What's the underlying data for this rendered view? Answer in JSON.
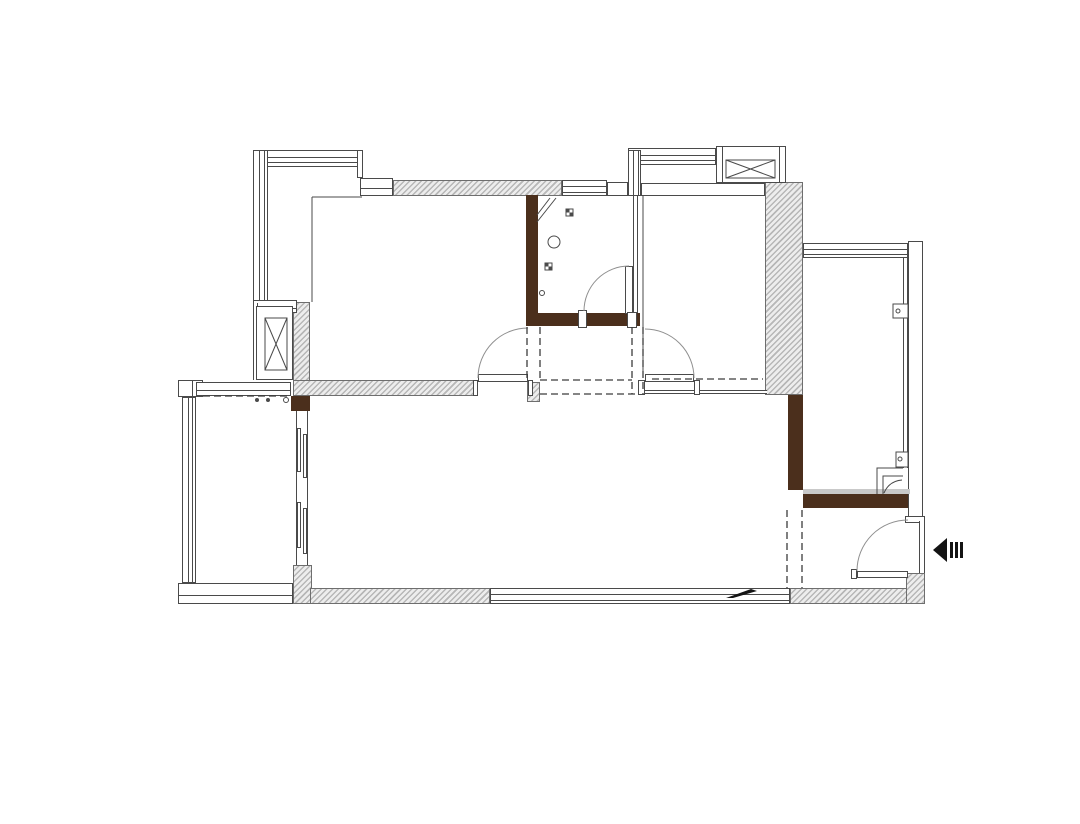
{
  "canvas": {
    "width": 1080,
    "height": 824,
    "background": "#ffffff"
  },
  "colors": {
    "line": "#4a4a4a",
    "arc": "#8f8f8f",
    "dash": "#3c3c3c",
    "black": "#141414",
    "wall_brown": "#4b2f1c",
    "hatch_bg": "#ededed",
    "hatch_stripe": "#b7b7b7",
    "gray_band": "#c9c9c9",
    "paper": "#ffffff"
  },
  "plan": {
    "hatched_walls": [
      {
        "name": "wall-top-bedroom1",
        "x": 393,
        "y": 180,
        "w": 169,
        "h": 16
      },
      {
        "name": "wall-left-shaft-side",
        "x": 293,
        "y": 302,
        "w": 17,
        "h": 82
      },
      {
        "name": "wall-bedroom1-south",
        "x": 293,
        "y": 380,
        "w": 185,
        "h": 16
      },
      {
        "name": "wall-hall-corner",
        "x": 527,
        "y": 382,
        "w": 13,
        "h": 20
      },
      {
        "name": "wall-bedroom2-east",
        "x": 765,
        "y": 182,
        "w": 38,
        "h": 213
      },
      {
        "name": "wall-balcony-pier",
        "x": 293,
        "y": 565,
        "w": 19,
        "h": 39
      },
      {
        "name": "wall-living-south",
        "x": 310,
        "y": 588,
        "w": 180,
        "h": 16
      },
      {
        "name": "wall-entry-south",
        "x": 790,
        "y": 588,
        "w": 118,
        "h": 16
      },
      {
        "name": "wall-entry-corner",
        "x": 906,
        "y": 573,
        "w": 19,
        "h": 31
      }
    ],
    "brown_walls": [
      {
        "name": "wall-bathroom-west",
        "x": 526,
        "y": 195,
        "w": 12,
        "h": 130
      },
      {
        "name": "wall-bathroom-south",
        "x": 526,
        "y": 313,
        "w": 114,
        "h": 13
      },
      {
        "name": "wall-balcony-door-pier",
        "x": 291,
        "y": 396,
        "w": 19,
        "h": 15
      },
      {
        "name": "wall-living-east",
        "x": 788,
        "y": 395,
        "w": 15,
        "h": 95
      },
      {
        "name": "wall-entry-north",
        "x": 803,
        "y": 494,
        "w": 107,
        "h": 14
      }
    ],
    "white_bands": [
      {
        "name": "bay-window-north",
        "x": 253,
        "y": 150,
        "w": 107,
        "h": 17,
        "style": "h2"
      },
      {
        "name": "bay-window-west",
        "x": 253,
        "y": 150,
        "w": 15,
        "h": 153,
        "style": "v2"
      },
      {
        "name": "bay-window-cap",
        "x": 357,
        "y": 150,
        "w": 6,
        "h": 28,
        "style": "box"
      },
      {
        "name": "bay-step-band",
        "x": 360,
        "y": 178,
        "w": 33,
        "h": 18,
        "style": "h1"
      },
      {
        "name": "bay-sill-band",
        "x": 253,
        "y": 300,
        "w": 44,
        "h": 13,
        "style": "h1"
      },
      {
        "name": "bay-edge-line",
        "x": 253,
        "y": 303,
        "w": 5,
        "h": 77,
        "style": "v2only"
      },
      {
        "name": "shaft-left-box",
        "x": 256,
        "y": 306,
        "w": 37,
        "h": 74,
        "style": "box"
      },
      {
        "name": "bathroom-window",
        "x": 562,
        "y": 180,
        "w": 45,
        "h": 16,
        "style": "h2"
      },
      {
        "name": "wall-band-bath-ne",
        "x": 607,
        "y": 182,
        "w": 21,
        "h": 14,
        "style": "box"
      },
      {
        "name": "tr-bay-window-north",
        "x": 628,
        "y": 148,
        "w": 88,
        "h": 17,
        "style": "h2"
      },
      {
        "name": "tr-bay-window-west",
        "x": 628,
        "y": 150,
        "w": 13,
        "h": 46,
        "style": "v2"
      },
      {
        "name": "shaft-right-box",
        "x": 716,
        "y": 146,
        "w": 70,
        "h": 37,
        "style": "box"
      },
      {
        "name": "shaft-right-cap-left",
        "x": 716,
        "y": 146,
        "w": 7,
        "h": 37,
        "style": "box"
      },
      {
        "name": "shaft-right-cap-right",
        "x": 779,
        "y": 146,
        "w": 7,
        "h": 37,
        "style": "box"
      },
      {
        "name": "bedroom2-north-band",
        "x": 641,
        "y": 183,
        "w": 124,
        "h": 13,
        "style": "box"
      },
      {
        "name": "balcony-window-end-block",
        "x": 178,
        "y": 380,
        "w": 25,
        "h": 17,
        "style": "v1"
      },
      {
        "name": "balcony-north-band",
        "x": 196,
        "y": 382,
        "w": 95,
        "h": 14,
        "style": "h1"
      },
      {
        "name": "balcony-window-west",
        "x": 182,
        "y": 397,
        "w": 14,
        "h": 186,
        "style": "v2"
      },
      {
        "name": "balcony-south-band",
        "x": 178,
        "y": 583,
        "w": 115,
        "h": 21,
        "style": "h1"
      },
      {
        "name": "living-south-window",
        "x": 490,
        "y": 588,
        "w": 300,
        "h": 16,
        "style": "h2"
      },
      {
        "name": "rbalcony-north-window",
        "x": 803,
        "y": 243,
        "w": 105,
        "h": 15,
        "style": "h2"
      },
      {
        "name": "rbalcony-east-column",
        "x": 908,
        "y": 241,
        "w": 15,
        "h": 277,
        "style": "box"
      },
      {
        "name": "column-foot-cap",
        "x": 905,
        "y": 516,
        "w": 20,
        "h": 7,
        "style": "box"
      },
      {
        "name": "rbalcony-east-window-line",
        "x": 903,
        "y": 258,
        "w": 5,
        "h": 210,
        "style": "v2only"
      },
      {
        "name": "entry-east-edge",
        "x": 919,
        "y": 521,
        "w": 6,
        "h": 52,
        "style": "v2only"
      },
      {
        "name": "sliding-door-frame",
        "x": 296,
        "y": 411,
        "w": 12,
        "h": 154,
        "style": "v2only"
      },
      {
        "name": "sliding-panel-1",
        "x": 297,
        "y": 428,
        "w": 4,
        "h": 44,
        "style": "box"
      },
      {
        "name": "sliding-panel-2",
        "x": 303,
        "y": 434,
        "w": 4,
        "h": 44,
        "style": "box"
      },
      {
        "name": "sliding-panel-3",
        "x": 297,
        "y": 502,
        "w": 4,
        "h": 46,
        "style": "box"
      },
      {
        "name": "sliding-panel-4",
        "x": 303,
        "y": 508,
        "w": 4,
        "h": 46,
        "style": "box"
      },
      {
        "name": "bathroom-east-wall",
        "x": 633,
        "y": 196,
        "w": 5,
        "h": 117,
        "style": "v2only"
      },
      {
        "name": "bedroom2-south-sill",
        "x": 645,
        "y": 390,
        "w": 122,
        "h": 4,
        "style": "h2only"
      },
      {
        "name": "door-leaf-bedroom1",
        "x": 478,
        "y": 374,
        "w": 50,
        "h": 8,
        "style": "box"
      },
      {
        "name": "door-jamb-bedroom1-left",
        "x": 473,
        "y": 380,
        "w": 5,
        "h": 16,
        "style": "box"
      },
      {
        "name": "door-jamb-bedroom1-right",
        "x": 528,
        "y": 380,
        "w": 5,
        "h": 16,
        "style": "box"
      },
      {
        "name": "door-leaf-bedroom2",
        "x": 645,
        "y": 374,
        "w": 49,
        "h": 8,
        "style": "box"
      },
      {
        "name": "door-jamb-bedroom2-left",
        "x": 638,
        "y": 380,
        "w": 7,
        "h": 15,
        "style": "box"
      },
      {
        "name": "door-jamb-bedroom2-right",
        "x": 694,
        "y": 380,
        "w": 6,
        "h": 15,
        "style": "box"
      },
      {
        "name": "door-leaf-bathroom",
        "x": 625,
        "y": 266,
        "w": 8,
        "h": 48,
        "style": "box"
      },
      {
        "name": "door-jamb-bathroom-left",
        "x": 578,
        "y": 310,
        "w": 9,
        "h": 18,
        "style": "box"
      },
      {
        "name": "door-jamb-bathroom-right",
        "x": 627,
        "y": 312,
        "w": 10,
        "h": 16,
        "style": "box"
      },
      {
        "name": "door-leaf-entry",
        "x": 857,
        "y": 571,
        "w": 51,
        "h": 7,
        "style": "box"
      },
      {
        "name": "door-jamb-entry",
        "x": 851,
        "y": 569,
        "w": 6,
        "h": 10,
        "style": "box"
      },
      {
        "name": "entry-north-gray-band",
        "x": 803,
        "y": 489,
        "w": 107,
        "h": 5,
        "style": "gray"
      }
    ],
    "svg_items": [
      {
        "name": "bedroom1-bay-edge-v",
        "type": "path",
        "d": "M312,197 L312,302",
        "stroke": "line"
      },
      {
        "name": "bedroom1-bay-edge-h",
        "type": "path",
        "d": "M312,197 L362,197",
        "stroke": "line"
      },
      {
        "name": "bedroom2-west-wall",
        "type": "path",
        "d": "M643,196 L643,378",
        "stroke": "line"
      },
      {
        "name": "shaft-left-duct",
        "type": "rect",
        "x": 265,
        "y": 318,
        "w": 22,
        "h": 52,
        "stroke": "line",
        "fill": "none"
      },
      {
        "name": "shaft-left-x-icon",
        "type": "path",
        "d": "M265,318 L287,370 M287,318 L265,370",
        "stroke": "line"
      },
      {
        "name": "shaft-right-duct",
        "type": "rect",
        "x": 726,
        "y": 160,
        "w": 49,
        "h": 18,
        "stroke": "line",
        "fill": "none"
      },
      {
        "name": "shaft-right-x-icon",
        "type": "path",
        "d": "M726,160 L775,178 M775,160 L726,178",
        "stroke": "line"
      },
      {
        "name": "door-arc-bedroom1",
        "type": "path",
        "d": "M478,378 A50,50 0 0 1 528,328",
        "stroke": "arc",
        "fill": "none"
      },
      {
        "name": "door-arc-bedroom2",
        "type": "path",
        "d": "M645,329 A49,49 0 0 1 694,378",
        "stroke": "arc",
        "fill": "none"
      },
      {
        "name": "door-arc-bathroom",
        "type": "path",
        "d": "M584,311 A45,45 0 0 1 629,266",
        "stroke": "arc",
        "fill": "none"
      },
      {
        "name": "door-arc-entry",
        "type": "path",
        "d": "M857,571 A51,51 0 0 1 908,520",
        "stroke": "arc",
        "fill": "none"
      },
      {
        "name": "hall-dash-west-1",
        "type": "path",
        "d": "M527,327 L527,380",
        "stroke": "dash",
        "dash": true
      },
      {
        "name": "hall-dash-west-2",
        "type": "path",
        "d": "M540,327 L540,380",
        "stroke": "dash",
        "dash": true
      },
      {
        "name": "hall-dash-east-1",
        "type": "path",
        "d": "M632,327 L632,394",
        "stroke": "dash",
        "dash": true
      },
      {
        "name": "hall-dash-east-2",
        "type": "path",
        "d": "M643,327 L643,394",
        "stroke": "dash",
        "dash": true
      },
      {
        "name": "hall-dash-south-1",
        "type": "path",
        "d": "M540,380 L632,380",
        "stroke": "dash",
        "dash": true
      },
      {
        "name": "hall-dash-south-2",
        "type": "path",
        "d": "M540,394 L637,394",
        "stroke": "dash",
        "dash": true
      },
      {
        "name": "bedroom2-opening-dash",
        "type": "path",
        "d": "M652,379 L763,379",
        "stroke": "dash",
        "dash": true
      },
      {
        "name": "entry-opening-dash-1",
        "type": "path",
        "d": "M787,510 L787,588",
        "stroke": "dash",
        "dash": true
      },
      {
        "name": "entry-opening-dash-2",
        "type": "path",
        "d": "M802,510 L802,588",
        "stroke": "dash",
        "dash": true
      },
      {
        "name": "balcony-opening-dash",
        "type": "path",
        "d": "M203,396 L291,396",
        "stroke": "dash",
        "dash": true
      },
      {
        "name": "floor-drain-1-icon",
        "type": "rect",
        "x": 566,
        "y": 209,
        "w": 7,
        "h": 7,
        "stroke": "line",
        "fill": "none"
      },
      {
        "name": "floor-drain-1-fill",
        "type": "path",
        "d": "M566,209 h3.5 v3.5 h-3.5 Z M569.5,212.5 h3.5 v3.5 h-3.5 Z",
        "fill": "line",
        "stroke": "none"
      },
      {
        "name": "floor-drain-2-icon",
        "type": "rect",
        "x": 545,
        "y": 263,
        "w": 7,
        "h": 7,
        "stroke": "line",
        "fill": "none"
      },
      {
        "name": "floor-drain-2-fill",
        "type": "path",
        "d": "M545,263 h3.5 v3.5 h-3.5 Z M548.5,266.5 h3.5 v3.5 h-3.5 Z",
        "fill": "line",
        "stroke": "none"
      },
      {
        "name": "bathroom-circle-fixture",
        "type": "circle",
        "cx": 554,
        "cy": 242,
        "r": 6,
        "stroke": "line",
        "fill": "none"
      },
      {
        "name": "bathroom-small-circle",
        "type": "circle",
        "cx": 542,
        "cy": 293,
        "r": 2.5,
        "stroke": "line",
        "fill": "none"
      },
      {
        "name": "shower-corner-icon",
        "type": "path",
        "d": "M537,222 L556,198 M537,215 L550,198",
        "stroke": "line",
        "fill": "none"
      },
      {
        "name": "rbalcony-corner-detail",
        "type": "path",
        "d": "M877,494 L877,468 L903,468 M883,494 L883,476 L903,476 M884,493 Q889,481 902,480",
        "stroke": "line",
        "fill": "none"
      },
      {
        "name": "window-latch-1-icon",
        "type": "rect",
        "x": 893,
        "y": 304,
        "w": 15,
        "h": 14,
        "stroke": "line",
        "fill": "#ffffff"
      },
      {
        "name": "window-latch-1-dot",
        "type": "circle",
        "cx": 898,
        "cy": 311,
        "r": 2,
        "stroke": "line",
        "fill": "none"
      },
      {
        "name": "window-latch-2-icon",
        "type": "rect",
        "x": 896,
        "y": 452,
        "w": 12,
        "h": 15,
        "stroke": "line",
        "fill": "#ffffff"
      },
      {
        "name": "window-latch-2-dot",
        "type": "circle",
        "cx": 900,
        "cy": 459,
        "r": 2,
        "stroke": "line",
        "fill": "none"
      },
      {
        "name": "balcony-dot-1",
        "type": "circle",
        "cx": 257,
        "cy": 400,
        "r": 2,
        "fill": "line",
        "stroke": "none"
      },
      {
        "name": "balcony-dot-2",
        "type": "circle",
        "cx": 268,
        "cy": 400,
        "r": 2,
        "fill": "line",
        "stroke": "none"
      },
      {
        "name": "balcony-dot-3",
        "type": "circle",
        "cx": 286,
        "cy": 400,
        "r": 2.5,
        "stroke": "line",
        "fill": "none"
      },
      {
        "name": "sill-marker-icon",
        "type": "path",
        "d": "M726,598 L751,589 L757,591 L733,598 Z",
        "fill": "black",
        "stroke": "none"
      },
      {
        "name": "entrance-arrow-icon",
        "type": "path",
        "d": "M933,550 L947,538 L947,562 Z",
        "fill": "black",
        "stroke": "none"
      },
      {
        "name": "entrance-arrow-bar-1",
        "type": "rect",
        "x": 950,
        "y": 542,
        "w": 3,
        "h": 16,
        "fill": "black",
        "stroke": "none"
      },
      {
        "name": "entrance-arrow-bar-2",
        "type": "rect",
        "x": 955,
        "y": 542,
        "w": 3,
        "h": 16,
        "fill": "black",
        "stroke": "none"
      },
      {
        "name": "entrance-arrow-bar-3",
        "type": "rect",
        "x": 960,
        "y": 542,
        "w": 3,
        "h": 16,
        "fill": "black",
        "stroke": "none"
      }
    ]
  }
}
